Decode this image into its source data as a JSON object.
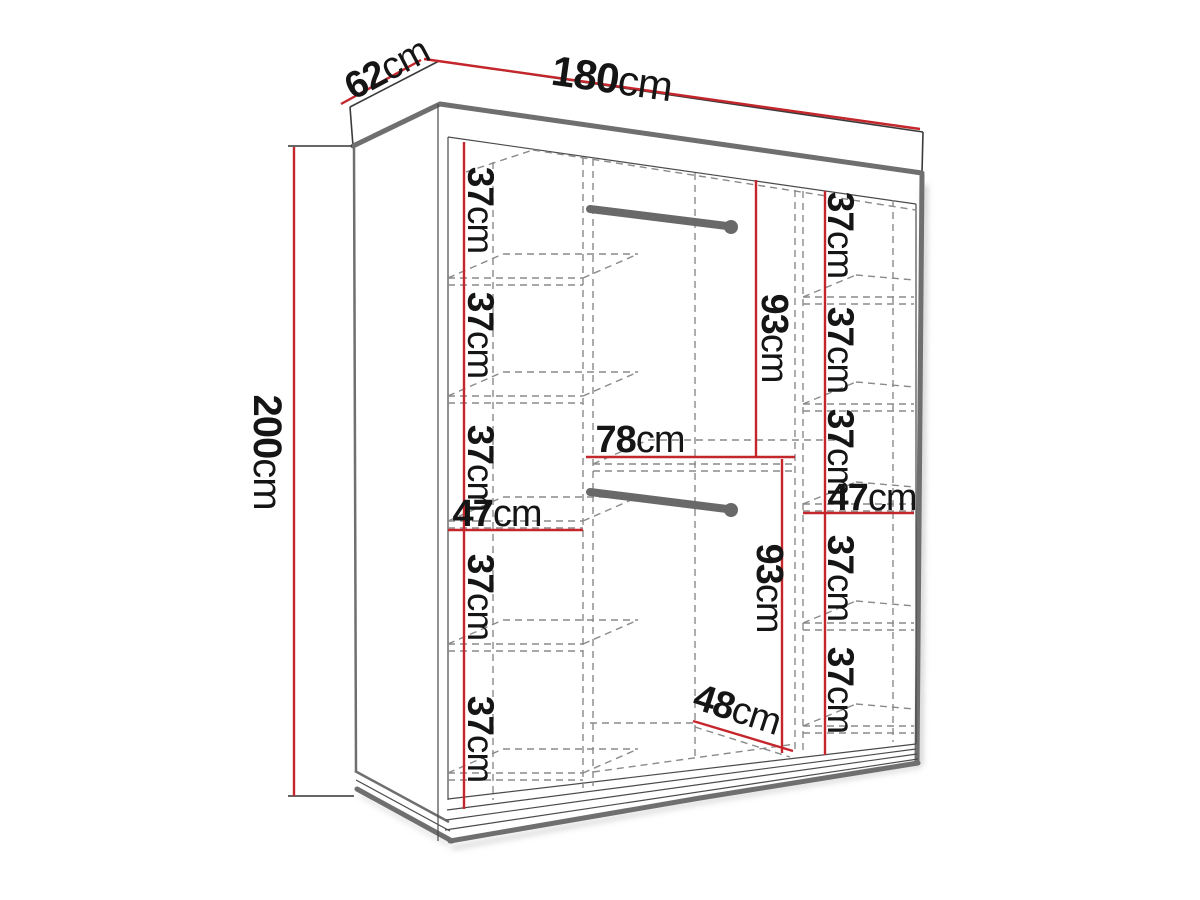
{
  "diagram": {
    "title": "wardrobe-dimensions",
    "unit": "cm",
    "overall": {
      "width": {
        "value": "180",
        "unit": "cm"
      },
      "depth": {
        "value": "62",
        "unit": "cm"
      },
      "height": {
        "value": "200",
        "unit": "cm"
      }
    },
    "left_column": {
      "width": {
        "value": "47",
        "unit": "cm"
      },
      "sections": [
        {
          "value": "37",
          "unit": "cm"
        },
        {
          "value": "37",
          "unit": "cm"
        },
        {
          "value": "37",
          "unit": "cm"
        },
        {
          "value": "37",
          "unit": "cm"
        },
        {
          "value": "37",
          "unit": "cm"
        }
      ]
    },
    "right_column": {
      "width": {
        "value": "47",
        "unit": "cm"
      },
      "sections": [
        {
          "value": "37",
          "unit": "cm"
        },
        {
          "value": "37",
          "unit": "cm"
        },
        {
          "value": "37",
          "unit": "cm"
        },
        {
          "value": "37",
          "unit": "cm"
        },
        {
          "value": "37",
          "unit": "cm"
        }
      ]
    },
    "middle_section": {
      "width": {
        "value": "78",
        "unit": "cm"
      },
      "floor_depth": {
        "value": "48",
        "unit": "cm"
      },
      "upper_hanging_height": {
        "value": "93",
        "unit": "cm"
      },
      "lower_hanging_height": {
        "value": "93",
        "unit": "cm"
      }
    },
    "colors": {
      "dimension_line": "#c5262c",
      "outline": "#3a3a3a",
      "panel_edge": "#6f6f6f",
      "hidden_line": "#8a8a8a",
      "text": "#151515",
      "background": "#ffffff"
    }
  }
}
